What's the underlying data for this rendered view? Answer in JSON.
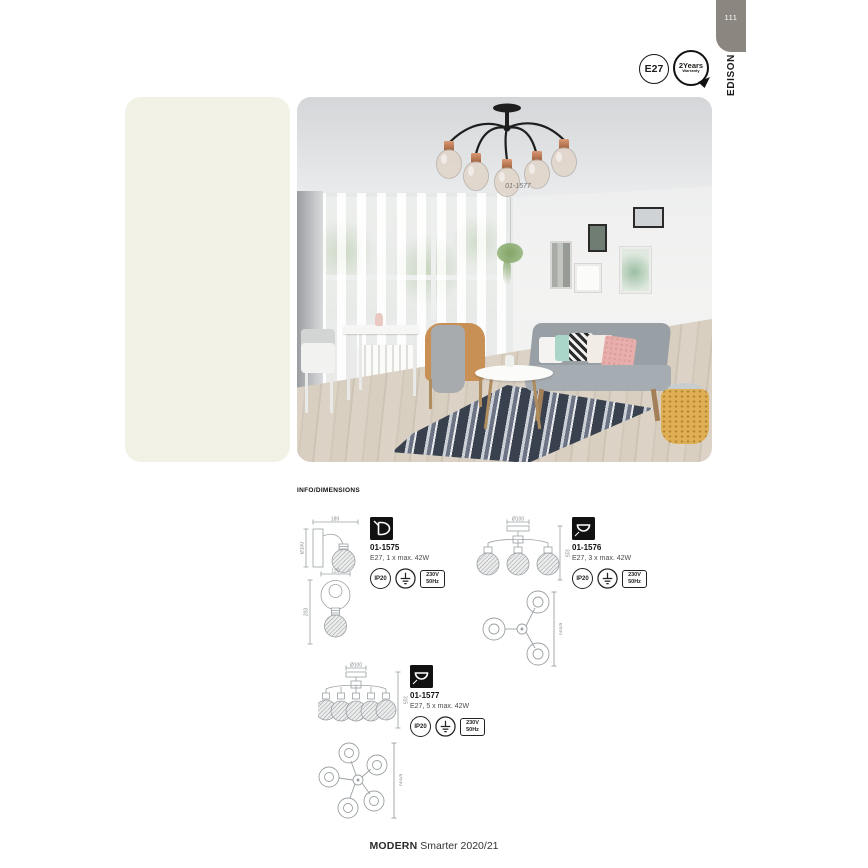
{
  "page": {
    "number": "111",
    "section_tab": "EDISON",
    "footer": {
      "brand": "MODERN",
      "edition": "Smarter 2020/21"
    }
  },
  "badges": {
    "socket": "E27",
    "warranty_line1": "2Years",
    "warranty_line2": "Warranty"
  },
  "hero": {
    "photo_label": "01-1577"
  },
  "info_header": "INFO/DIMENSIONS",
  "products": [
    {
      "code": "01-1575",
      "spec": "E27, 1 x max. 42W",
      "icon": "wall-light-icon",
      "dims": {
        "proj": "189",
        "base": "Ø100",
        "width": "120",
        "height": "203"
      },
      "cert": {
        "ip": "IP20",
        "volt1": "230V",
        "volt2": "50Hz"
      }
    },
    {
      "code": "01-1576",
      "spec": "E27, 3 x max. 42W",
      "icon": "ceiling-light-icon",
      "dims": {
        "canopy": "Ø100",
        "height": "315",
        "spread": "Ø530"
      },
      "cert": {
        "ip": "IP20",
        "volt1": "230V",
        "volt2": "50Hz"
      }
    },
    {
      "code": "01-1577",
      "spec": "E27, 5 x max. 42W",
      "icon": "ceiling-light-icon",
      "dims": {
        "canopy": "Ø100",
        "height": "315",
        "spread": "Ø530"
      },
      "cert": {
        "ip": "IP20",
        "volt1": "230V",
        "volt2": "50Hz"
      }
    }
  ],
  "colors": {
    "cream_panel": "#f2f1e6",
    "tab_gray": "#8b8680",
    "copper": "#c08160",
    "rug_navy": "#39414f",
    "drawing_gray": "#9aa0a3"
  }
}
